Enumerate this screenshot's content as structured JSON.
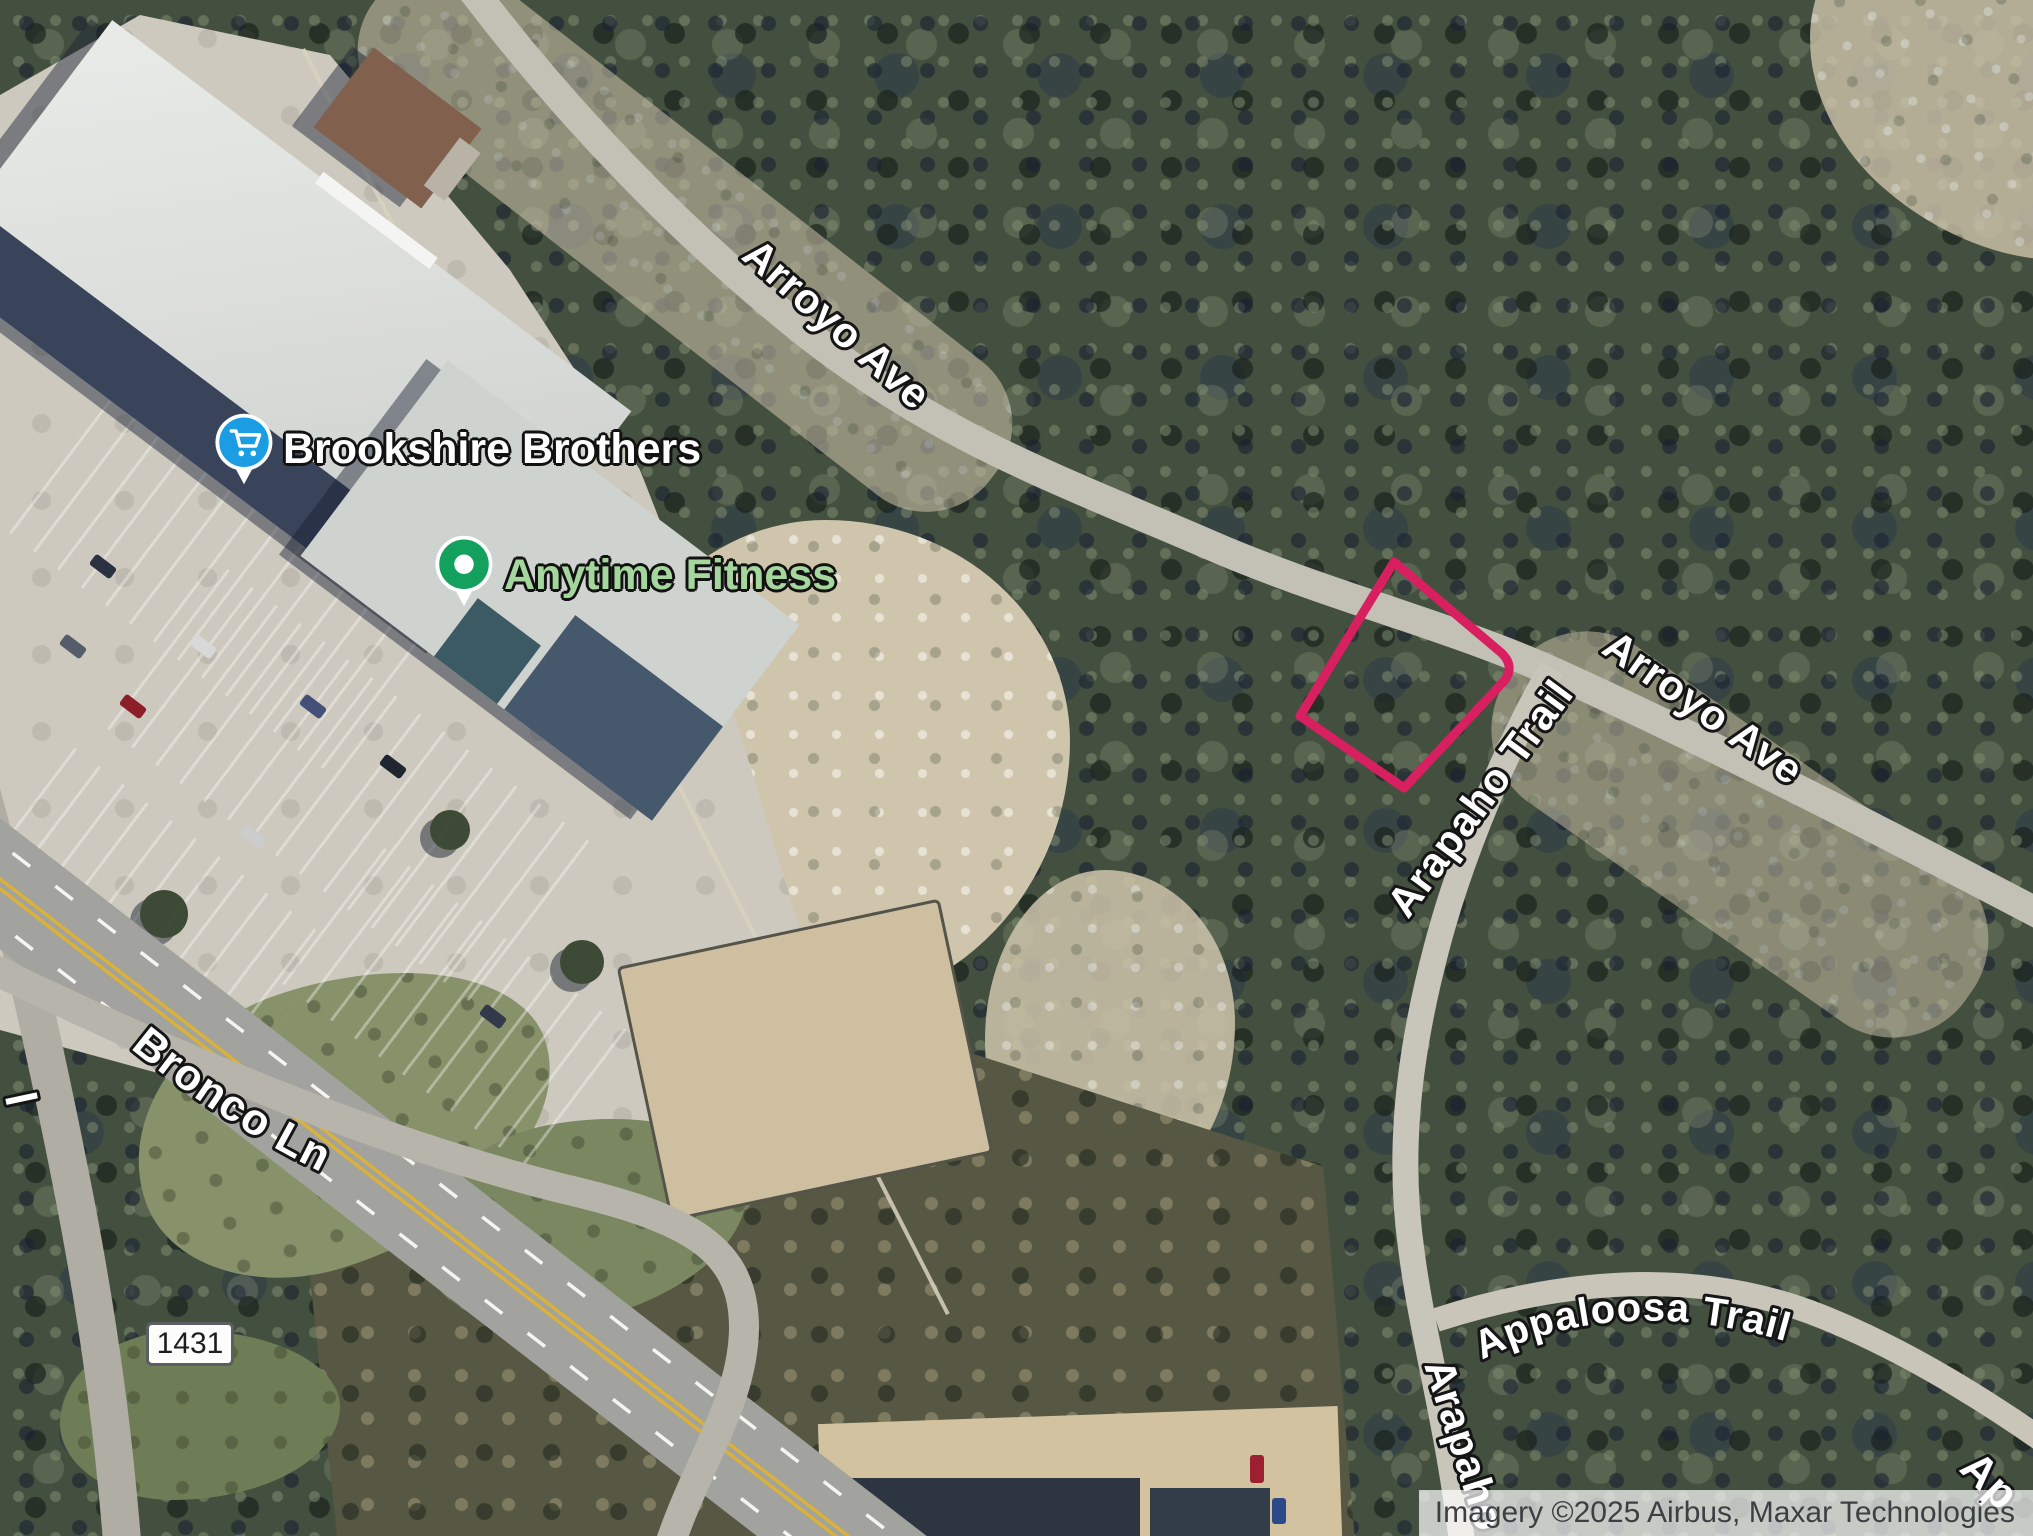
{
  "map": {
    "attribution": "Imagery ©2025 Airbus, Maxar Technologies",
    "route_shield": "1431",
    "streets": {
      "arroyo_ave_top": "Arroyo Ave",
      "arroyo_ave_right": "Arroyo Ave",
      "arapaho_trail": "Arapaho Trail",
      "arapaho_trail_bottom": "Arapaho",
      "appaloosa_trail": "Appaloosa Trail",
      "appaloosa_trail_corner": "Ap",
      "bronco_ln": "Bronco Ln",
      "left_edge_partial": "l"
    },
    "places": [
      {
        "name": "Brookshire Brothers",
        "icon": "shopping-cart-pin",
        "pin_color": "#1b9de4",
        "label_color": "#ffffff"
      },
      {
        "name": "Anytime Fitness",
        "icon": "circle-dot-pin",
        "pin_color": "#14a15e",
        "label_color": "#a5d69d"
      }
    ],
    "property_outline_color": "#d81f60"
  }
}
